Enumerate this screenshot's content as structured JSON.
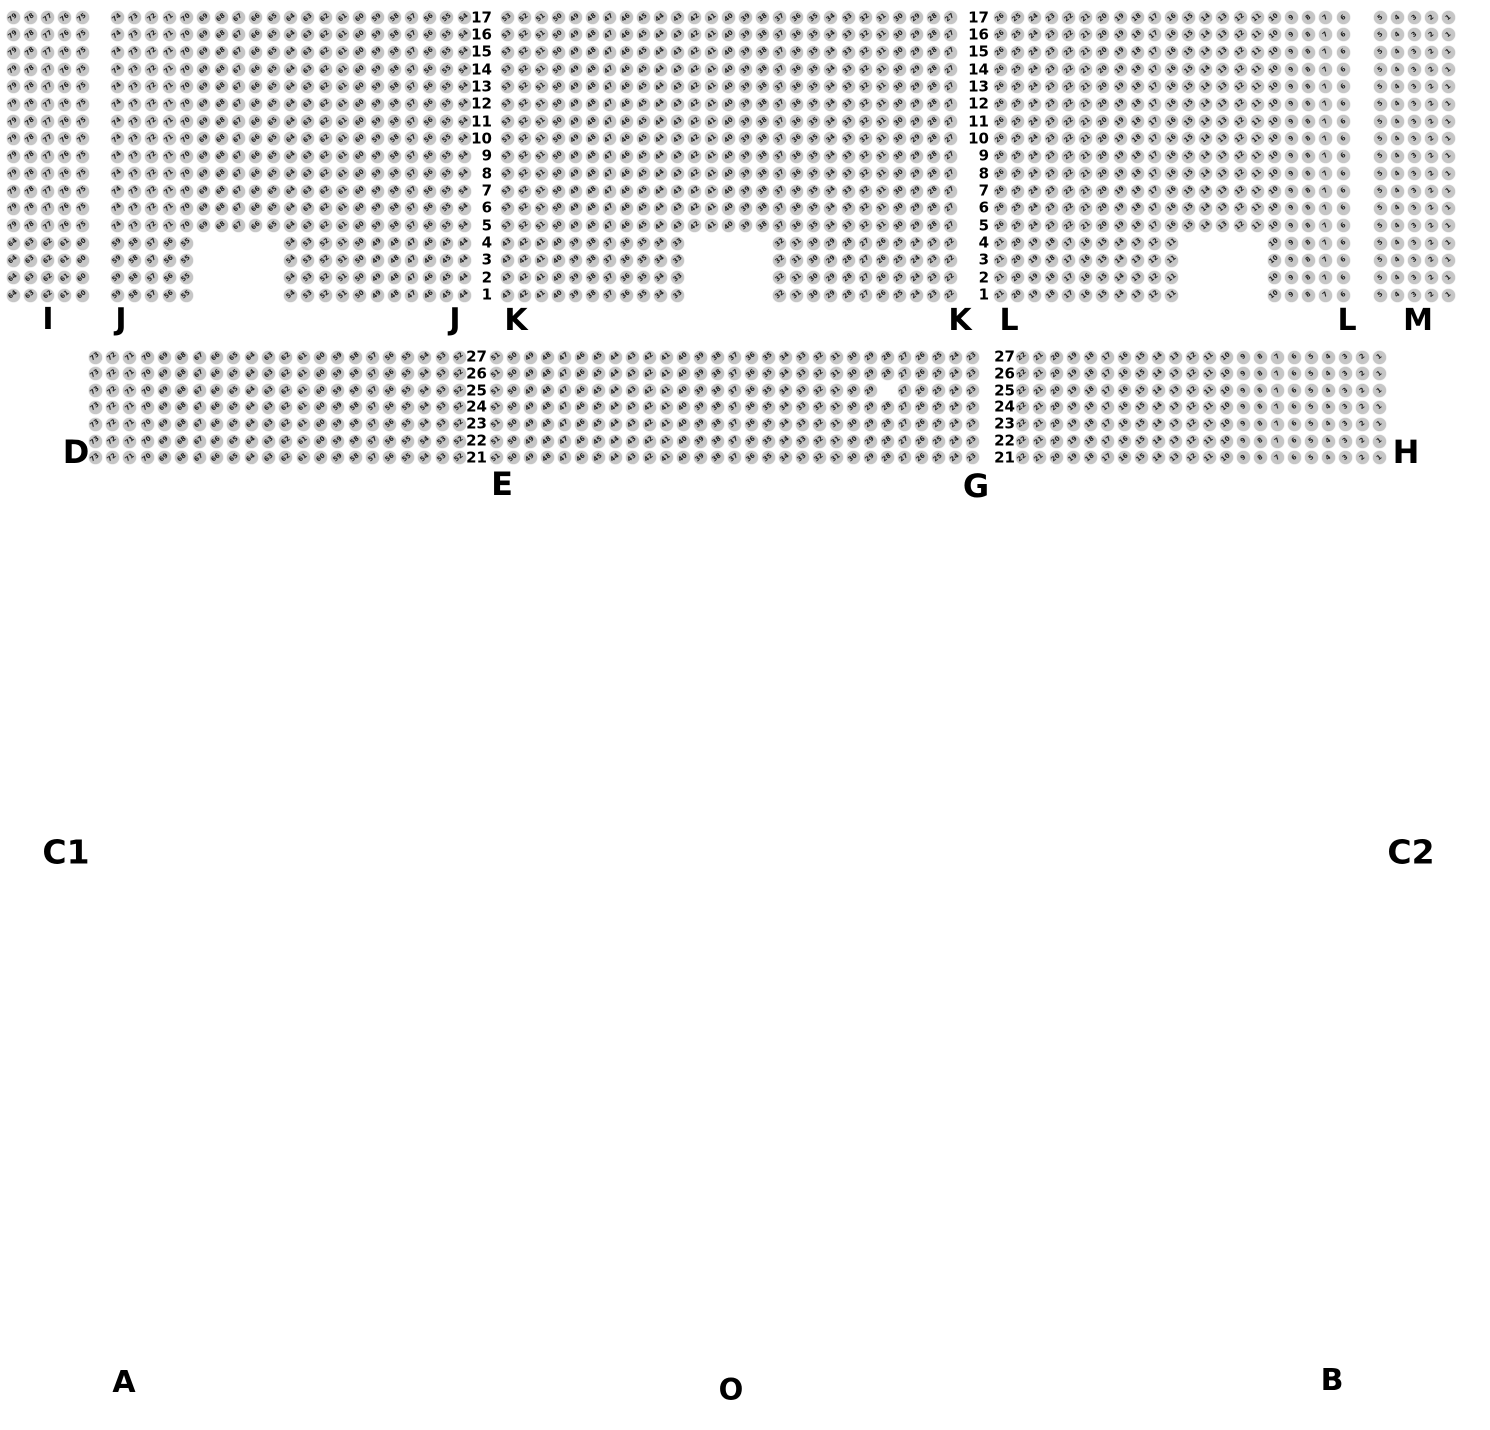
{
  "page": {
    "width": 1490,
    "height": 1430,
    "background": "#ffffff"
  },
  "seat_style": {
    "diameter": 13,
    "fill": "#c6c6c6",
    "number_color": "#1c1c1c",
    "number_rotation_deg": -38,
    "number_scale": 0.66
  },
  "top_band": {
    "row_numbers_top_to_bottom": [
      17,
      16,
      15,
      14,
      13,
      12,
      11,
      10,
      9,
      8,
      7,
      6,
      5,
      4,
      3,
      2,
      1
    ],
    "full_rows": [
      17,
      16,
      15,
      14,
      13,
      12,
      11,
      10,
      9,
      8,
      7,
      6,
      5
    ],
    "notch_rows": [
      4,
      3,
      2,
      1
    ],
    "y_top": 17.5,
    "row_pitch": 17.35,
    "row_label_columns": [
      {
        "right_x": 492
      },
      {
        "right_x": 989
      }
    ],
    "blocks": [
      {
        "section": "I",
        "scope": "full",
        "x0": 13,
        "pitch": 17.3,
        "cols": 5,
        "start_seat": 79
      },
      {
        "section": "I",
        "scope": "notch",
        "x0": 13,
        "pitch": 17.3,
        "cols": 5,
        "start_seat": 64
      },
      {
        "section": "J",
        "scope": "full",
        "x0": 117,
        "pitch": 17.35,
        "cols": 21,
        "start_seat": 74
      },
      {
        "section": "J",
        "scope": "notch",
        "x0": 117,
        "pitch": 17.35,
        "cols": 5,
        "start_seat": 59
      },
      {
        "section": "J",
        "scope": "notch",
        "x0": 290.5,
        "pitch": 17.35,
        "cols": 11,
        "start_seat": 54
      },
      {
        "section": "K",
        "scope": "full",
        "x0": 507,
        "pitch": 17.05,
        "cols": 27,
        "start_seat": 53
      },
      {
        "section": "K",
        "scope": "notch",
        "x0": 507,
        "pitch": 17.05,
        "cols": 11,
        "start_seat": 43
      },
      {
        "section": "K",
        "scope": "notch",
        "x0": 779.8,
        "pitch": 17.05,
        "cols": 11,
        "start_seat": 32
      },
      {
        "section": "L",
        "scope": "full",
        "x0": 1000,
        "pitch": 17.15,
        "cols": 21,
        "start_seat": 26
      },
      {
        "section": "L",
        "scope": "notch",
        "x0": 1000,
        "pitch": 17.15,
        "cols": 11,
        "start_seat": 21
      },
      {
        "section": "L",
        "scope": "notch",
        "x0": 1274.4,
        "pitch": 17.15,
        "cols": 5,
        "start_seat": 10
      },
      {
        "section": "M",
        "scope": "full",
        "x0": 1380,
        "pitch": 17.0,
        "cols": 5,
        "start_seat": 5
      },
      {
        "section": "M",
        "scope": "notch",
        "x0": 1380,
        "pitch": 17.0,
        "cols": 5,
        "start_seat": 5
      }
    ]
  },
  "lower_band": {
    "row_numbers_top_to_bottom": [
      27,
      26,
      25,
      24,
      23,
      22,
      21
    ],
    "y_top": 357,
    "row_pitch": 16.8,
    "row_label_columns": [
      {
        "right_x": 487
      },
      {
        "right_x": 1015
      }
    ],
    "blocks": [
      {
        "section": "D",
        "x0": 95,
        "pitch": 17.35,
        "cols": 22,
        "start_seat": 73
      },
      {
        "section": "E-G",
        "x0": 496,
        "pitch": 17.0,
        "cols": 29,
        "start_seat": 51,
        "missing_seats": [
          {
            "row": 25,
            "seat": 28
          }
        ]
      },
      {
        "section": "H",
        "x0": 1022,
        "pitch": 17.0,
        "cols": 22,
        "start_seat": 22
      }
    ]
  },
  "section_labels": [
    {
      "id": "i",
      "text": "I",
      "x": 48,
      "y": 320,
      "size": 30
    },
    {
      "id": "j-left",
      "text": "J",
      "x": 121,
      "y": 320,
      "size": 30
    },
    {
      "id": "j-right",
      "text": "J",
      "x": 455,
      "y": 320,
      "size": 30
    },
    {
      "id": "k-left",
      "text": "K",
      "x": 516,
      "y": 321,
      "size": 30
    },
    {
      "id": "k-right",
      "text": "K",
      "x": 960,
      "y": 321,
      "size": 30
    },
    {
      "id": "l-left",
      "text": "L",
      "x": 1009,
      "y": 321,
      "size": 30
    },
    {
      "id": "l-right",
      "text": "L",
      "x": 1347,
      "y": 321,
      "size": 30
    },
    {
      "id": "m",
      "text": "M",
      "x": 1418,
      "y": 321,
      "size": 30
    },
    {
      "id": "d",
      "text": "D",
      "x": 76,
      "y": 452,
      "size": 32
    },
    {
      "id": "e",
      "text": "E",
      "x": 502,
      "y": 484,
      "size": 32
    },
    {
      "id": "g",
      "text": "G",
      "x": 976,
      "y": 486,
      "size": 32
    },
    {
      "id": "h",
      "text": "H",
      "x": 1406,
      "y": 452,
      "size": 32
    }
  ],
  "area_labels": [
    {
      "id": "c1",
      "text": "C1",
      "x": 66,
      "y": 852,
      "size": 33
    },
    {
      "id": "c2",
      "text": "C2",
      "x": 1411,
      "y": 852,
      "size": 33
    },
    {
      "id": "a",
      "text": "A",
      "x": 124,
      "y": 1383,
      "size": 30
    },
    {
      "id": "o",
      "text": "O",
      "x": 731,
      "y": 1390,
      "size": 29
    },
    {
      "id": "b",
      "text": "B",
      "x": 1332,
      "y": 1381,
      "size": 30
    }
  ]
}
